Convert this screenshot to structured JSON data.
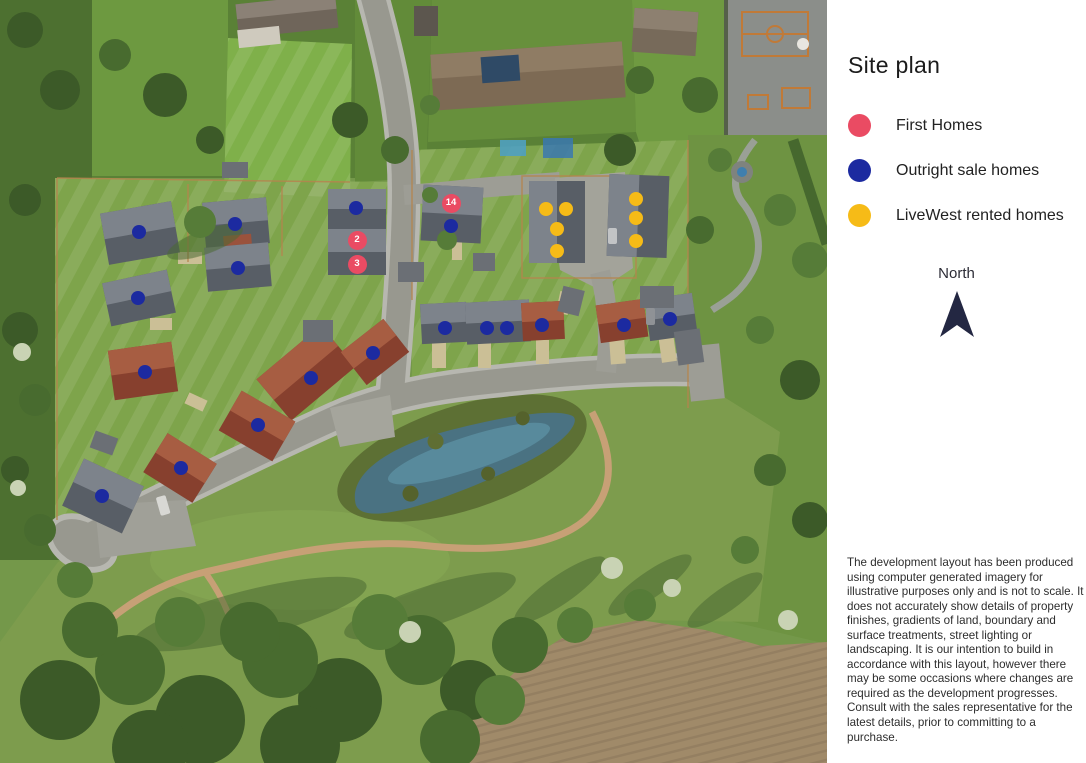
{
  "sidebar": {
    "title": "Site plan",
    "legend": [
      {
        "key": "first",
        "label": "First Homes",
        "color": "#ea4b63"
      },
      {
        "key": "outright",
        "label": "Outright sale homes",
        "color": "#1c2aa0"
      },
      {
        "key": "rented",
        "label": "LiveWest rented homes",
        "color": "#f6bb17"
      }
    ],
    "north": {
      "label": "North",
      "arrow_color": "#232742"
    },
    "disclaimer": "The development layout has been produced using computer generated imagery for illustrative purposes only and is not to scale. It does not accurately show details of property finishes, gradients of land, boundary and surface treatments, street lighting or landscaping. It is our intention to build in accordance with this layout, however there may be some occasions where changes are required as the development progresses. Consult with the sales representative for the latest details, prior to committing to a purchase."
  },
  "map": {
    "markers": [
      {
        "x": 451,
        "y": 203,
        "type": "first",
        "label": "14"
      },
      {
        "x": 357,
        "y": 240,
        "type": "first",
        "label": "2"
      },
      {
        "x": 357,
        "y": 264,
        "type": "first",
        "label": "3"
      },
      {
        "x": 139,
        "y": 232,
        "type": "outright",
        "label": ""
      },
      {
        "x": 235,
        "y": 224,
        "type": "outright",
        "label": ""
      },
      {
        "x": 238,
        "y": 268,
        "type": "outright",
        "label": ""
      },
      {
        "x": 138,
        "y": 298,
        "type": "outright",
        "label": ""
      },
      {
        "x": 145,
        "y": 372,
        "type": "outright",
        "label": ""
      },
      {
        "x": 311,
        "y": 378,
        "type": "outright",
        "label": ""
      },
      {
        "x": 373,
        "y": 353,
        "type": "outright",
        "label": ""
      },
      {
        "x": 258,
        "y": 425,
        "type": "outright",
        "label": ""
      },
      {
        "x": 181,
        "y": 468,
        "type": "outright",
        "label": ""
      },
      {
        "x": 102,
        "y": 496,
        "type": "outright",
        "label": ""
      },
      {
        "x": 356,
        "y": 208,
        "type": "outright",
        "label": ""
      },
      {
        "x": 451,
        "y": 226,
        "type": "outright",
        "label": ""
      },
      {
        "x": 445,
        "y": 328,
        "type": "outright",
        "label": ""
      },
      {
        "x": 487,
        "y": 328,
        "type": "outright",
        "label": ""
      },
      {
        "x": 507,
        "y": 328,
        "type": "outright",
        "label": ""
      },
      {
        "x": 542,
        "y": 325,
        "type": "outright",
        "label": ""
      },
      {
        "x": 624,
        "y": 325,
        "type": "outright",
        "label": ""
      },
      {
        "x": 670,
        "y": 319,
        "type": "outright",
        "label": ""
      },
      {
        "x": 546,
        "y": 209,
        "type": "rented",
        "label": ""
      },
      {
        "x": 566,
        "y": 209,
        "type": "rented",
        "label": ""
      },
      {
        "x": 557,
        "y": 229,
        "type": "rented",
        "label": ""
      },
      {
        "x": 557,
        "y": 251,
        "type": "rented",
        "label": ""
      },
      {
        "x": 636,
        "y": 199,
        "type": "rented",
        "label": ""
      },
      {
        "x": 636,
        "y": 218,
        "type": "rented",
        "label": ""
      },
      {
        "x": 636,
        "y": 241,
        "type": "rented",
        "label": ""
      }
    ]
  }
}
